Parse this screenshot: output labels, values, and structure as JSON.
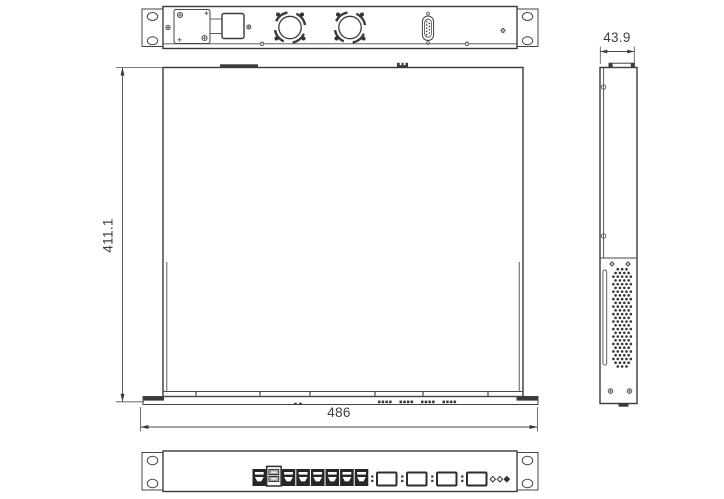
{
  "canvas": {
    "width": 724,
    "height": 499,
    "background": "#ffffff"
  },
  "colors": {
    "line": "#454545",
    "line_dark": "#383838",
    "fill_dark": "#3a3a3a",
    "text": "#3e3e3e"
  },
  "dimensions": {
    "depth": "411.1",
    "width": "486",
    "height": "43.9"
  },
  "rear_panel": {
    "fan_count": 2,
    "serial_connector": "db9",
    "rack_ear_count": 2
  },
  "front_panel": {
    "port_row_total": 8,
    "usb_stack_position": 2,
    "sfp_count": 4,
    "led_count": 3,
    "rack_ear_count": 2
  },
  "side_panel": {
    "vent": "perforated"
  }
}
